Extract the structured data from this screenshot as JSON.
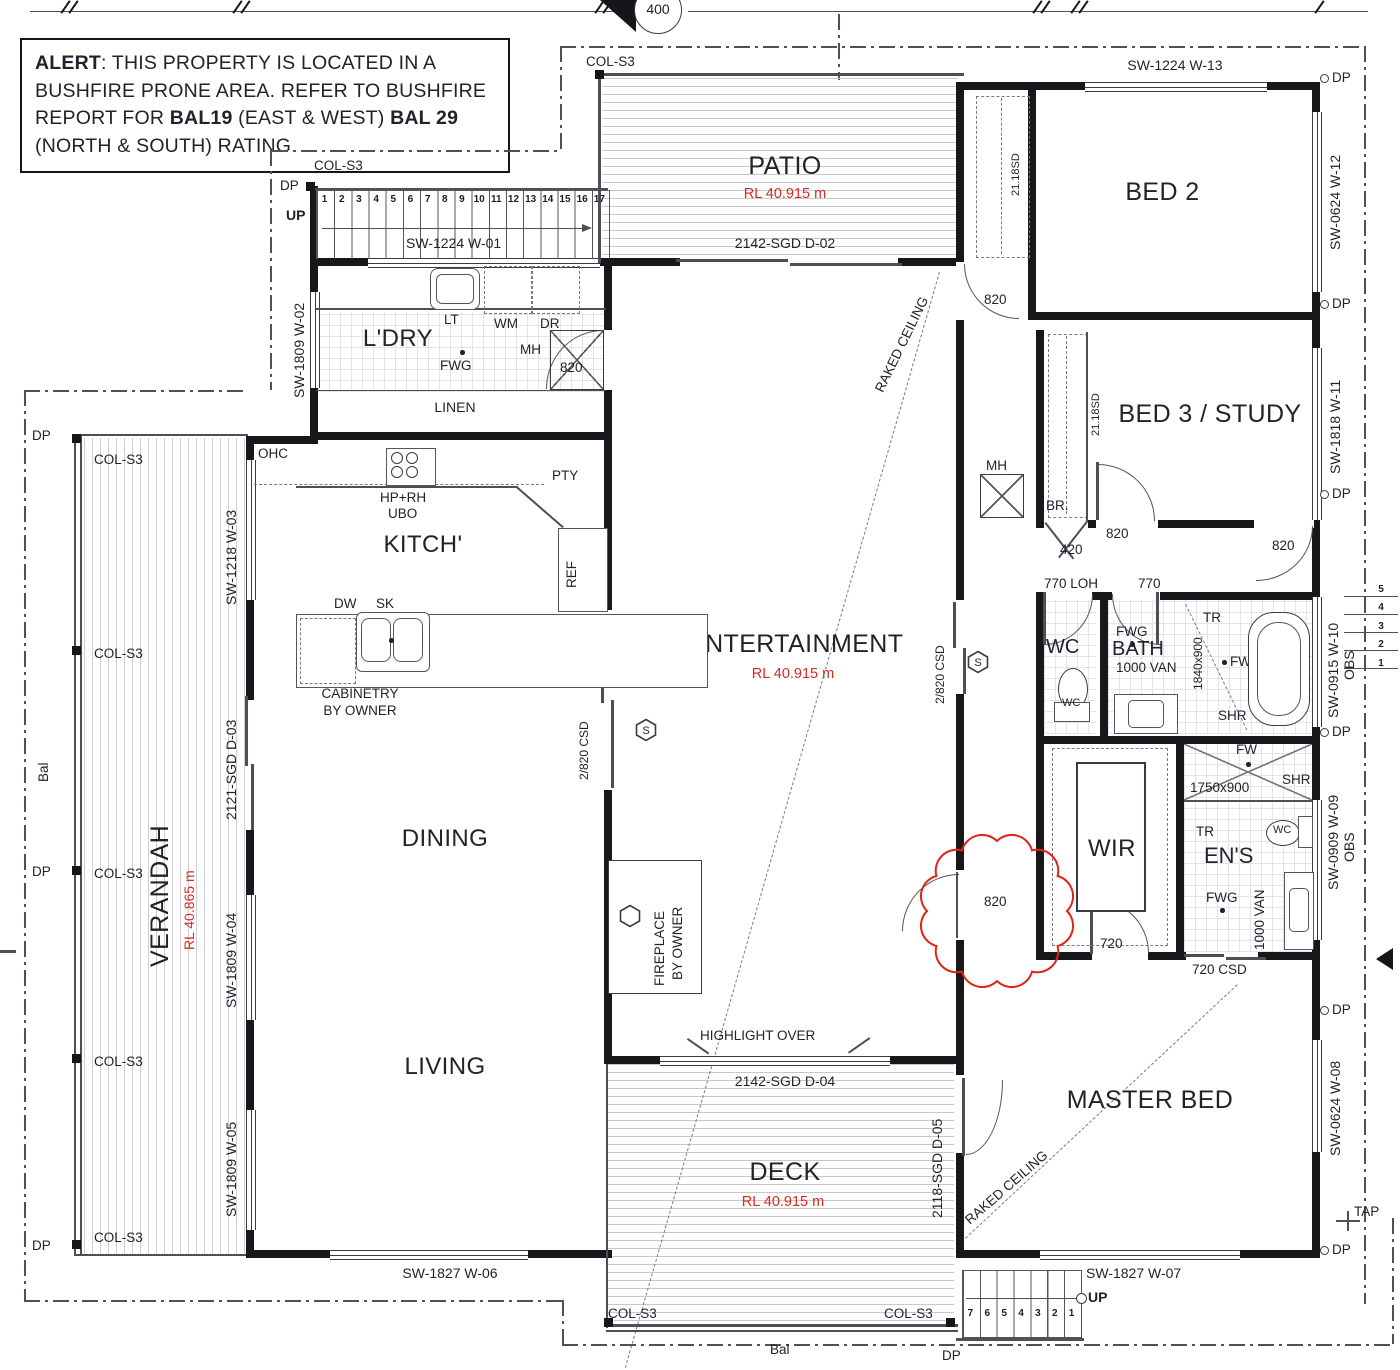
{
  "colors": {
    "accent_red": "#d92a1e",
    "wall": "#17171c",
    "text": "#22222c"
  },
  "alert": {
    "b1": "ALERT",
    "t1": ": THIS PROPERTY IS LOCATED IN A BUSHFIRE PRONE AREA. REFER TO BUSHFIRE REPORT FOR ",
    "b2": "BAL19",
    "t2": " (EAST & WEST) ",
    "b3": "BAL 29",
    "t3": " (NORTH & SOUTH) RATING"
  },
  "marker": {
    "detail": "400"
  },
  "rooms": {
    "patio": "PATIO",
    "patio_rl": "RL 40.915 m",
    "bed2": "BED 2",
    "bed3": "BED 3 / STUDY",
    "ldry": "L'DRY",
    "linen": "LINEN",
    "kitch": "KITCH'",
    "dining": "DINING",
    "living": "LIVING",
    "verandah": "VERANDAH",
    "verandah_rl": "RL 40.865 m",
    "ent": "ENTERTAINMENT",
    "ent_rl": "RL 40.915 m",
    "deck": "DECK",
    "deck_rl": "RL 40.915 m",
    "master": "MASTER BED",
    "wir": "WIR",
    "ens": "EN'S",
    "wc": "WC",
    "bath": "BATH",
    "br": "BR."
  },
  "openings": {
    "w01": "SW-1224 W-01",
    "w02": "SW-1809 W-02",
    "w03": "SW-1218 W-03",
    "w04": "SW-1809 W-04",
    "w05": "SW-1809 W-05",
    "w06": "SW-1827 W-06",
    "w07": "SW-1827 W-07",
    "w08": "SW-0624 W-08",
    "w09": "SW-0909 W-09",
    "w10": "SW-0915 W-10",
    "w11": "SW-1818 W-11",
    "w12": "SW-0624 W-12",
    "w13": "SW-1224 W-13",
    "d02": "2142-SGD  D-02",
    "d03": "2121-SGD  D-03",
    "d04": "2142-SGD  D-04",
    "d05": "2118-SGD  D-05",
    "obs": "OBS",
    "csd720": "720 CSD",
    "csd2820": "2/820 CSD"
  },
  "fx": {
    "lt": "LT",
    "wm": "WM",
    "dr": "DR",
    "mh": "MH",
    "fwg": "FWG",
    "ohc": "OHC",
    "hprh": "HP+RH",
    "ubo": "UBO",
    "pty": "PTY",
    "ref": "REF",
    "dw": "DW",
    "sk": "SK",
    "cab1": "CABINETRY",
    "cab2": "BY OWNER",
    "fp1": "FIREPLACE",
    "fp2": "BY OWNER",
    "tr": "TR",
    "fw": "FW",
    "btf": "BT-F",
    "shr": "SHR",
    "van": "1000 VAN",
    "s1840": "1840x900",
    "s1750": "1750x900",
    "wcs": "WC",
    "s": "S"
  },
  "g": {
    "dp": "DP",
    "col": "COL-S3",
    "up": "UP",
    "bal": "Bal",
    "tap": "TAP",
    "raked": "RAKED CEILING",
    "highlight": "HIGHLIGHT OVER",
    "sd": "21.18SD",
    "d820": "820",
    "d420": "420",
    "d720": "720",
    "d770": "770",
    "loh": "770 LOH"
  },
  "stairs": {
    "top": [
      "1",
      "2",
      "3",
      "4",
      "5",
      "6",
      "7",
      "8",
      "9",
      "10",
      "11",
      "12",
      "13",
      "14",
      "15",
      "16",
      "17"
    ],
    "bottom": [
      "7",
      "6",
      "5",
      "4",
      "3",
      "2",
      "1"
    ],
    "right": [
      "5",
      "4",
      "3",
      "2",
      "1"
    ]
  }
}
